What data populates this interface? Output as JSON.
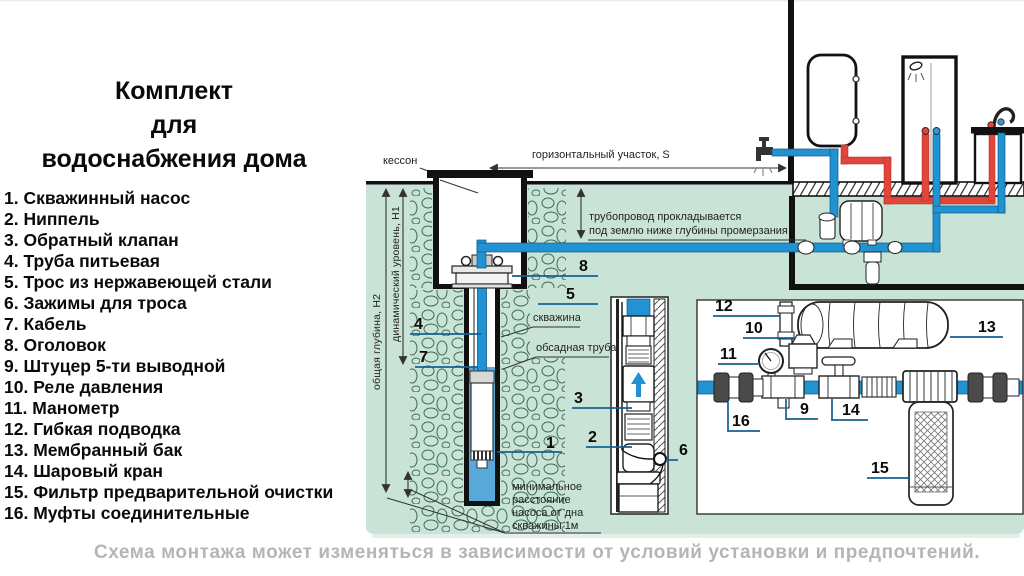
{
  "title": "Комплект\nдля\nводоснабжения дома",
  "legend": {
    "items": [
      "1. Скважинный насос",
      "2. Ниппель",
      "3. Обратный клапан",
      "4. Труба питьевая",
      "5. Трос из нержавеющей стали",
      "6. Зажимы для троса",
      "7. Кабель",
      "8. Оголовок",
      "9. Штуцер 5-ти выводной",
      "10. Реле давления",
      "11. Манометр",
      "12. Гибкая подводка",
      "13. Мембранный бак",
      "14. Шаровый кран",
      "15. Фильтр предварительной очистки",
      "16. Муфты соединительные"
    ]
  },
  "footer": {
    "note": "Схема монтажа может изменяться в зависимости от условий установки и предпочтений."
  },
  "diagram": {
    "annotations": {
      "caisson": "кессон",
      "horizontal_section": "горизонтальный участок, S",
      "pipeline_note": "трубопровод прокладывается\nпод землю ниже глубины промерзания",
      "total_depth": "общая глубина, Н2",
      "dynamic_level": "динамический уровень, Н1",
      "borehole": "скважина",
      "casing_pipe": "обсадная труба",
      "min_distance": "минимальное\nрасстояние\nнасоса от дна\nскважины 1м"
    },
    "callouts": [
      "1",
      "2",
      "3",
      "4",
      "5",
      "6",
      "7",
      "8",
      "9",
      "10",
      "11",
      "12",
      "13",
      "14",
      "15",
      "16"
    ],
    "colors": {
      "pipe_cold": "#2193d2",
      "pipe_hot": "#e2453c",
      "ground": "#c9e3d7",
      "water": "#58a9d9",
      "leader": "#15618f"
    }
  }
}
